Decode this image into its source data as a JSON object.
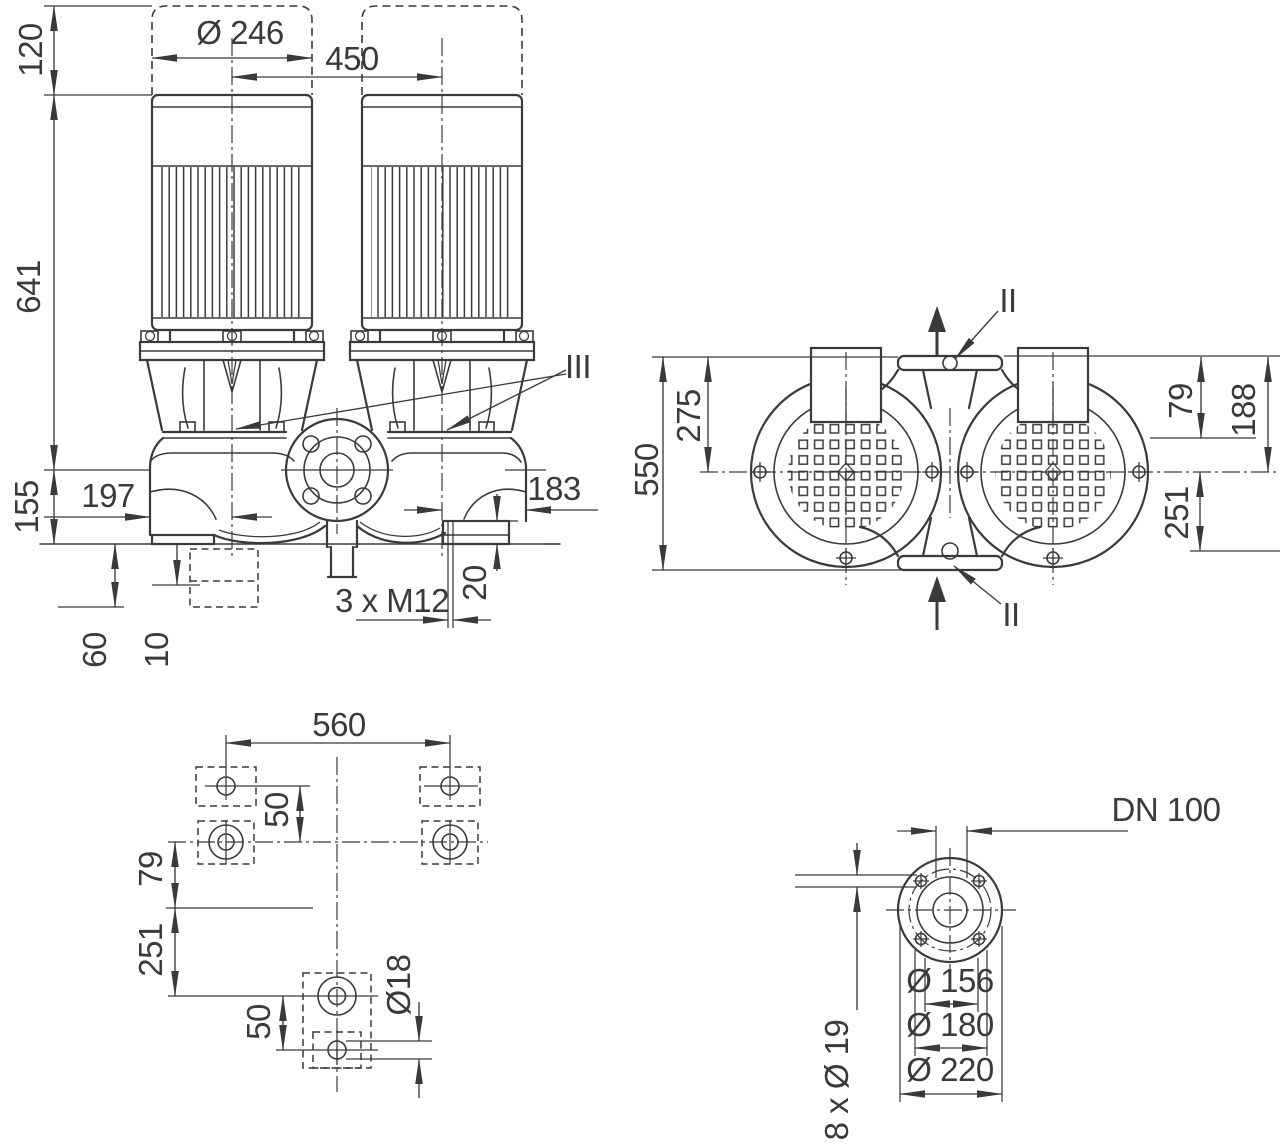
{
  "front_view": {
    "dim_clearance": "120",
    "dim_motor_diameter": "Ø 246",
    "dim_motor_spacing": "450",
    "dim_height": "641",
    "dim_base_height": "155",
    "dim_left_offset": "197",
    "dim_right_offset": "183",
    "note_foot_threads": "3 x M12",
    "dim_foot_height": "20",
    "dim_recess_depth": "60",
    "dim_recess_offset": "10",
    "ref_seal": "III"
  },
  "top_view": {
    "dim_overall": "550",
    "dim_center_offset": "275",
    "dim_79": "79",
    "dim_188": "188",
    "dim_251": "251",
    "ref_port_top": "II",
    "ref_port_bottom": "II"
  },
  "foot_plan": {
    "dim_foot_spacing": "560",
    "dim_upper_hole_offset": "50",
    "dim_79": "79",
    "dim_251": "251",
    "dim_lower_hole_offset": "50",
    "dim_hole_diameter": "Ø18"
  },
  "flange_view": {
    "label_nominal": "DN 100",
    "dim_pilot": "Ø 156",
    "dim_bolt_circle": "Ø 180",
    "dim_outer": "Ø 220",
    "note_bolt_holes": "8 x Ø 19"
  }
}
